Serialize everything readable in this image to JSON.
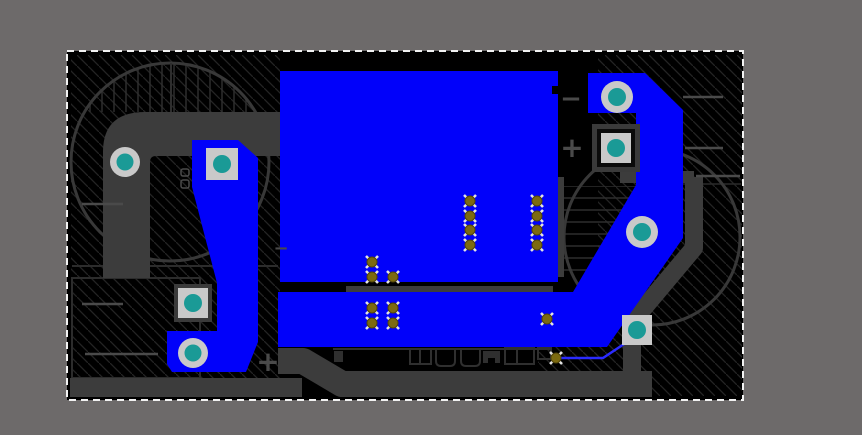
{
  "window": {
    "background": "#6d6a6a",
    "title": "pcb-editor-canvas"
  },
  "board": {
    "x": 67,
    "y": 51,
    "width": 676,
    "height": 349,
    "fill": "#000000",
    "selection": {
      "color": "#f2f2f2",
      "dash": "7 5"
    }
  },
  "palette": {
    "bg": "#6d6a6a",
    "copper_top": "#0101fa",
    "copper_top_thin": "#2b2bff",
    "copper_bottom": "#3c3c3c",
    "hatch": "#242424",
    "patch_line": "#2e2e2e",
    "circle_outline": "#383838",
    "outline_dark": "#2f2f2f",
    "silk": "#4a4a4a",
    "pad_ring": "#c9c9c9",
    "pad_hole": "#1a9a96",
    "pedestal_outer": "#3a3a3a",
    "pedestal_inner": "#0b0b0b",
    "via_fill": "#7c6a10",
    "via_ring": "#52450a",
    "via_tick": "#e3e3e3",
    "selection": "#f2f2f2"
  },
  "marks": [
    {
      "id": "minus-right",
      "value": "−",
      "x": 571,
      "y": 107,
      "size": 26
    },
    {
      "id": "plus-right",
      "value": "+",
      "x": 572,
      "y": 157,
      "size": 28
    },
    {
      "id": "plus-bottom-left",
      "value": "+",
      "x": 268,
      "y": 371,
      "size": 28
    },
    {
      "id": "minus-left",
      "value": "−",
      "x": 281,
      "y": 254,
      "size": 18
    }
  ],
  "pads": [
    {
      "id": "pad-round-left-top",
      "shape": "round",
      "x": 125,
      "y": 162,
      "ring": 15,
      "hole": 8.5
    },
    {
      "id": "pad-round-left-bottom",
      "shape": "round",
      "x": 193,
      "y": 353,
      "ring": 15,
      "hole": 8.5
    },
    {
      "id": "pad-round-right-top",
      "shape": "round",
      "x": 617,
      "y": 97,
      "ring": 16,
      "hole": 9
    },
    {
      "id": "pad-round-right-mid",
      "shape": "round",
      "x": 642,
      "y": 232,
      "ring": 16,
      "hole": 9
    },
    {
      "id": "pad-square-left-top",
      "shape": "square",
      "x": 222,
      "y": 164,
      "size": 32,
      "hole": 9
    },
    {
      "id": "pad-square-left-bottom",
      "shape": "square",
      "x": 193,
      "y": 303,
      "size": 30,
      "hole": 9,
      "pedestal": 38
    },
    {
      "id": "pad-square-right-top",
      "shape": "square",
      "x": 616,
      "y": 148,
      "size": 30,
      "hole": 9,
      "pedestal": 48
    },
    {
      "id": "pad-square-right-bottom",
      "shape": "square",
      "x": 637,
      "y": 330,
      "size": 30,
      "hole": 9
    }
  ],
  "vias": [
    [
      470,
      201
    ],
    [
      470,
      216
    ],
    [
      470,
      230
    ],
    [
      470,
      245
    ],
    [
      537,
      201
    ],
    [
      537,
      216
    ],
    [
      537,
      230
    ],
    [
      537,
      245
    ],
    [
      372,
      262
    ],
    [
      372,
      277
    ],
    [
      393,
      277
    ],
    [
      372,
      308
    ],
    [
      393,
      308
    ],
    [
      372,
      323
    ],
    [
      393,
      323
    ],
    [
      547,
      319
    ],
    [
      556,
      358
    ]
  ],
  "silk_lines": [
    [
      82,
      204,
      123,
      204
    ],
    [
      82,
      304,
      123,
      304
    ],
    [
      85,
      354,
      158,
      354
    ],
    [
      683,
      97,
      723,
      97
    ],
    [
      685,
      148,
      723,
      148
    ],
    [
      696,
      176,
      740,
      176
    ]
  ]
}
